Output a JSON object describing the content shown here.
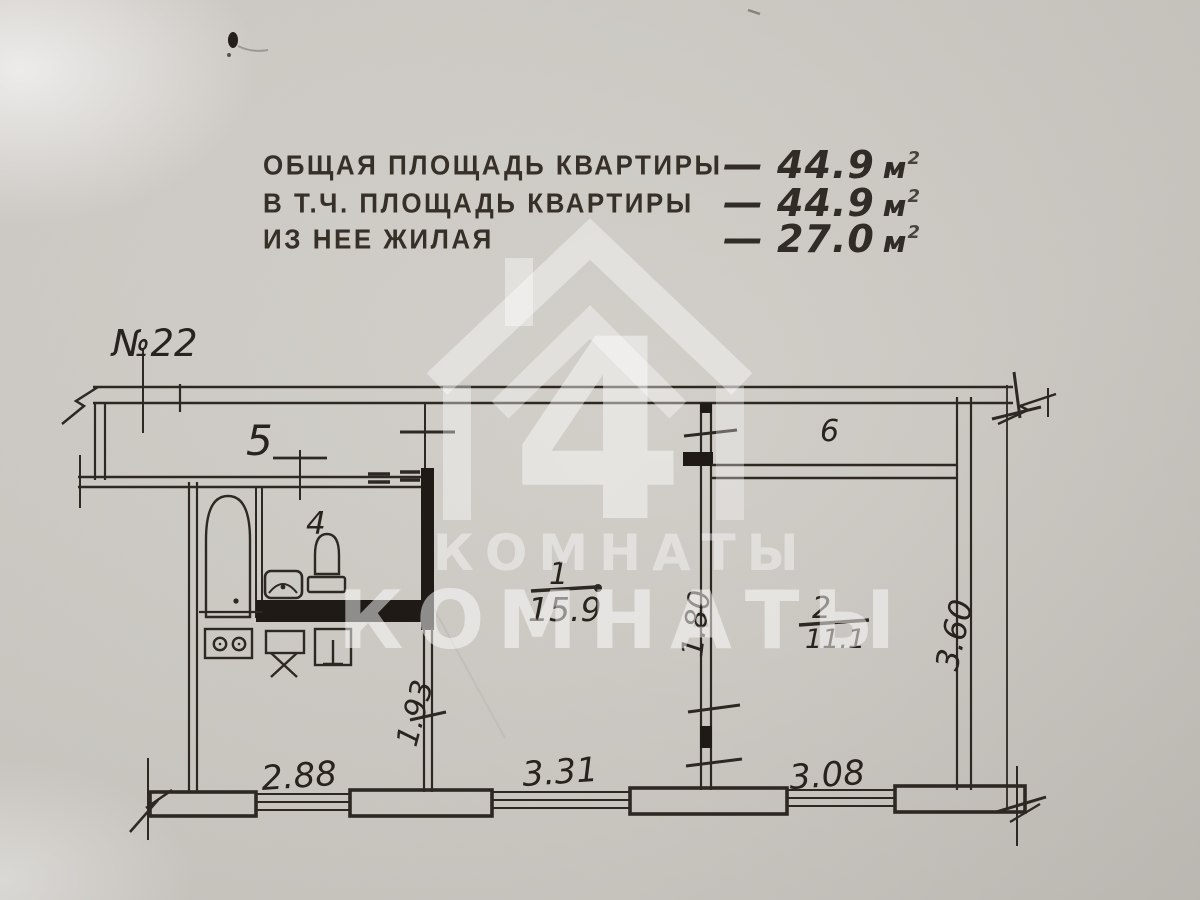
{
  "document": {
    "apartment_number": "№22",
    "header": {
      "lines": [
        {
          "label": "ОБЩАЯ ПЛОЩАДЬ КВАРТИРЫ",
          "dash": "—",
          "value": "44.9",
          "unit": "м",
          "sup": "2"
        },
        {
          "label": "В Т.Ч. ПЛОЩАДЬ КВАРТИРЫ",
          "dash": "—",
          "value": "44.9",
          "unit": "м",
          "sup": "2"
        },
        {
          "label": "ИЗ НЕЕ ЖИЛАЯ",
          "dash": "—",
          "value": "27.0",
          "unit": "м",
          "sup": "2"
        }
      ]
    },
    "rooms": {
      "corridor": "5",
      "bathroom": "4",
      "balcony": "6",
      "room1_num": "1",
      "room1_area": "15.9",
      "room2_num": "2",
      "room2_area": "11.1"
    },
    "dimensions": {
      "kitchen_width": "2.88",
      "room1_width": "3.31",
      "room2_width": "3.08",
      "kitchen_depth": "1.93",
      "hall_width": "1.80",
      "room2_depth": "3.60"
    },
    "watermark": {
      "logo_digit": "4",
      "text_small": "КОМНАТЫ",
      "text_large": "КОМНАТЫ"
    }
  },
  "colors": {
    "paper": "#cdc9c3",
    "ink": "#2b2520",
    "watermark": "#ffffff"
  }
}
